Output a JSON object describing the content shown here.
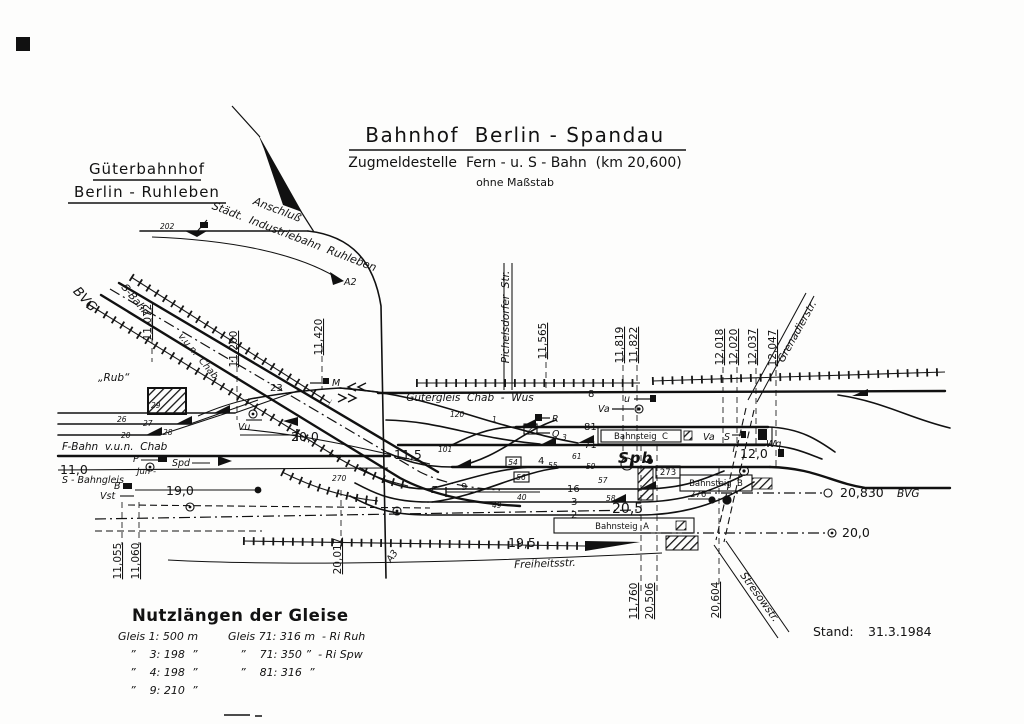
{
  "header": {
    "title": "Bahnhof  Berlin - Spandau",
    "subtitle": "Zugmeldestelle  Fern - u. S - Bahn  (km 20,600)",
    "scale_note": "ohne Maßstab"
  },
  "left_station": {
    "line1": "Güterbahnhof",
    "line2": "Berlin - Ruhleben"
  },
  "branch": {
    "line1": "Anschluß",
    "line2": "Städt.  Industriebahn  Ruhleben"
  },
  "route_labels": {
    "bvg_left": "BVG",
    "s_bahn": "S-Bahn",
    "vun_chab": "v.u.n.  Chab",
    "f_bahn": "F-Bahn  v.u.n.  Chab",
    "s_bahngleis": "S - Bahngleis",
    "jun": "Jun -",
    "gueter": "Gütergleis  Chab  -  Wus",
    "rub": "„Rub“",
    "spb": "Spb",
    "bvg_right": "BVG"
  },
  "streets": {
    "pichelsdorfer": "Pichelsdorfer  Str.",
    "grenadier": "Grenadierstr.",
    "freiheit": "Freiheitsstr.",
    "stresow": "Stresowstr."
  },
  "platforms": {
    "c": "Bahnsteig  C",
    "b": "Bahnsteig  B",
    "a": "Bahnsteig  A"
  },
  "km_posts": {
    "k11072": "11,072",
    "k11200": "11,200",
    "k11420": "11,420",
    "k11565": "11,565",
    "k11819": "11,819",
    "k11822": "11,822",
    "k12018": "12,018",
    "k12020": "12,020",
    "k12037": "12,037",
    "k12047": "12,047",
    "k11055": "11,055",
    "k11060": "11,060",
    "k20017": "20,017",
    "k11760": "11,760",
    "k20506": "20,506",
    "k20604": "20,604",
    "k20830": "20,830"
  },
  "lengths": {
    "l200_left": "20,0",
    "l115": "11,5",
    "l190": "19,0",
    "l110": "11,0",
    "l205": "20,5",
    "l195": "19,5",
    "l120": "12,0",
    "l200_right": "20,0"
  },
  "track_numbers": {
    "t8": "8",
    "t81": "81",
    "t71": "71",
    "t4": "4",
    "t16": "16",
    "t3": "3",
    "t2": "2",
    "t9": "9",
    "t23": "23"
  },
  "switch_numbers": {
    "s202": "202",
    "s20": "20",
    "s26": "26",
    "s27": "27",
    "s28": "28",
    "s29": "29",
    "s270": "270",
    "s120": "120",
    "s101": "101",
    "s1": "1",
    "s2": "2",
    "s3": "3",
    "s40": "40",
    "s49": "49",
    "s54": "54",
    "s55": "55",
    "s56": "56",
    "s57": "57",
    "s58": "58",
    "s59": "59",
    "s61": "61",
    "s273": "273",
    "s276": "276"
  },
  "signals": {
    "a2": "A2",
    "a3": "A3",
    "m": "M",
    "r": "R",
    "q": "Q",
    "u": "u",
    "va1": "Va",
    "va2": "Va",
    "s": "S",
    "t": "T",
    "wq": "Wq",
    "vu": "Vu",
    "e": "E",
    "p": "P",
    "spd": "Spd",
    "b": "B",
    "vst": "Vst"
  },
  "legend": {
    "heading": "Nutzlängen der Gleise",
    "col1": [
      "Gleis 1: 500 m",
      "”    3: 198  ”",
      "”    4: 198  ”",
      "”    9: 210  ”"
    ],
    "col2": [
      "Gleis 71: 316 m  - Ri Ruh",
      "”    71: 350 ”  - Ri Spw",
      "”    81: 316  ”"
    ]
  },
  "footer": {
    "stand_label": "Stand:",
    "stand_date": "31.3.1984"
  }
}
